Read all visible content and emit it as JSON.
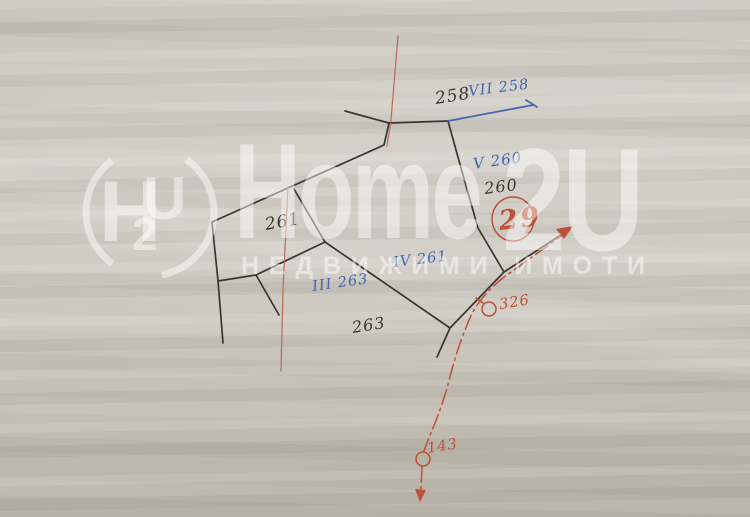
{
  "meta": {
    "width": 750,
    "height": 517,
    "kind": "cadastral-sketch-photo"
  },
  "colors": {
    "paper": "#cfcac2",
    "black_ink": "#3a3530",
    "blue_ink": "#4466ad",
    "red_ink": "#bc5038",
    "red_line": "#b85c47",
    "watermark": "rgba(255,255,255,0.47)"
  },
  "labels": {
    "p258": {
      "text": "258",
      "transform": "translate(436,104) rotate(-9)"
    },
    "p258_reg": {
      "text": "VII 258",
      "transform": "translate(469,96) rotate(-7)"
    },
    "p260": {
      "text": "260",
      "transform": "translate(485,194) rotate(-7)"
    },
    "p260_reg": {
      "text": "V 260",
      "transform": "translate(474,169) rotate(-8)"
    },
    "p261": {
      "text": "261",
      "transform": "translate(266,230) rotate(-10)"
    },
    "p261_reg": {
      "text": "IV 261",
      "transform": "translate(394,267) rotate(-7)"
    },
    "p263": {
      "text": "263",
      "transform": "translate(353,333) rotate(-9)"
    },
    "p263_reg": {
      "text": "III 263",
      "transform": "translate(313,291) rotate(-8)"
    },
    "pt326": {
      "text": "326",
      "transform": "translate(500,309) rotate(-9)"
    },
    "pt143": {
      "text": "143",
      "transform": "translate(428,453) rotate(-9)"
    },
    "plan29": {
      "text": "29",
      "transform": "translate(500,230) rotate(-7)"
    }
  },
  "geometry": {
    "north_boundary": "M345,111 L389,123 L448,121",
    "west_boundary": "M389,123 L384,145 L212,222 L218,281 L223,343",
    "inner_branch": "M218,281 L256,275 L279,315",
    "inner_spur": "M294,189 L325,242",
    "middle_boundary": "M256,275 L325,242 L450,328 L504,272",
    "south_tail": "M450,328 L437,357",
    "east_boundary": "M448,121 L461,168 L478,228 L504,272",
    "northeast_spur": "M504,272 L567,231",
    "blue_boundary": "M448,121 L533,105",
    "blue_tick": "M526,100 L537,107",
    "regulation_line_1": "M398,36 L391,120 L387,146",
    "regulation_line_2": "M288,187 L283,290 L281,371",
    "road_centerline": "M569,230 Q534,256 504,277 Q479,297 470,318 Q457,348 450,377 Q443,404 433,428 Q427,442 424,451",
    "road_stem": "M422,467 L421,489",
    "point_circle_326": "M496,309 a7,7 0 1,1 -14,0 a7,7 0 1,1 14,0",
    "point_tick_326": "M483,303 L476,298",
    "point_circle_143": "M430,459 a7,7 0 1,1 -14,0 a7,7 0 1,1 14,0",
    "circle_29": "M534,219 a21,22 0 1,1 -42,0 a21,22 0 1,1 42,0",
    "arrow_ne": "M573,226 L556,229 L564,239 Z",
    "arrow_s": "M420,502 L415,489 L426,490 Z"
  },
  "watermark": {
    "brand_main": "Home",
    "brand_suffix": "2U",
    "tagline": "НЕДВИЖИМИ ИМОТИ",
    "logo_letter_h": "H",
    "logo_letter_2": "2",
    "logo_letter_u": "U"
  }
}
